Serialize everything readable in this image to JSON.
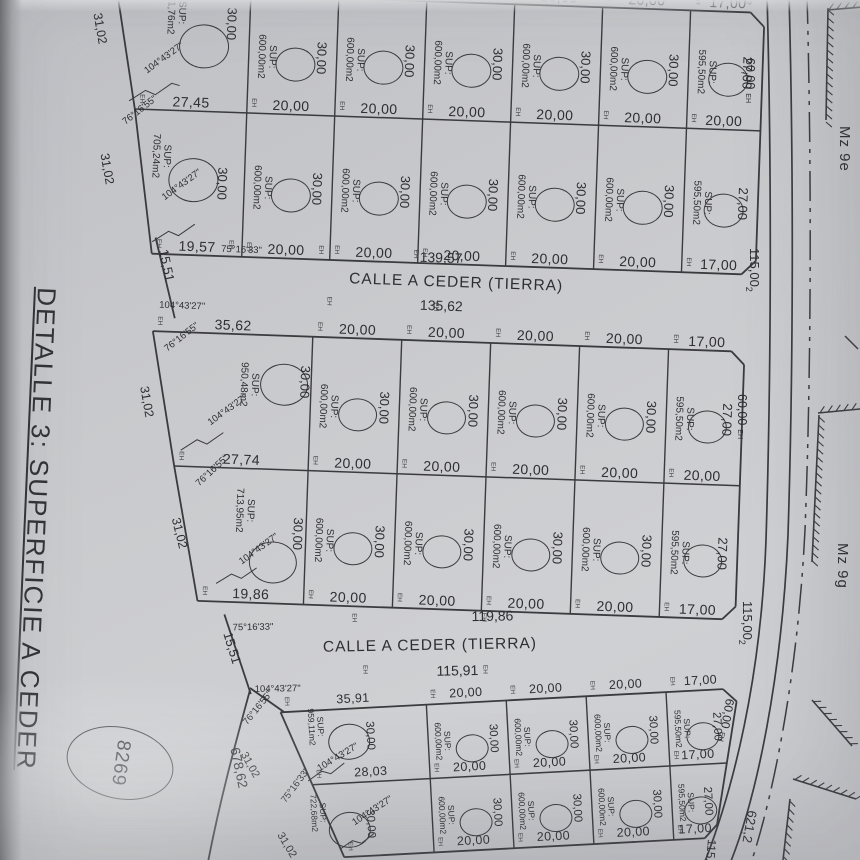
{
  "title": "DETALLE 3: SUPERFICIE A CEDER",
  "markers": {
    "eh": "EH"
  },
  "streets": [
    {
      "angle_nw": "75°16'33\"",
      "total_n": "139,57",
      "name": "CALLE A CEDER (TIERRA)",
      "total_s": "135,62",
      "angle_sw": "104°43'27\"",
      "width_w": "15,51"
    },
    {
      "angle_nw": "75°16'33\"",
      "total_n": "119,86",
      "name": "CALLE A CEDER (TIERRA)",
      "total_s": "115,91",
      "angle_sw": "104°43'27\"",
      "width_w": "15,51"
    }
  ],
  "right_side": {
    "mz_labels": [
      "Mz 9e",
      "Mz 9g"
    ],
    "block_width_label": "115,00",
    "width_sup": "2",
    "top_partial_sup": "2",
    "depth_label": "60,00",
    "road_length_label": "621,2",
    "partial_width_label": "115,0"
  },
  "left_annotations": {
    "parcel_number": "8269",
    "boundary_length": "678,62"
  },
  "blocks": [
    {
      "dims": {
        "top": [
          "",
          "20,00",
          "20,00",
          "20,00",
          "20,00",
          "20,00",
          "17,00"
        ],
        "mid": [
          "27,45",
          "20,00",
          "20,00",
          "20,00",
          "20,00",
          "20,00",
          "20,00"
        ],
        "bot": [
          "19,57",
          "20,00",
          "20,00",
          "20,00",
          "20,00",
          "20,00",
          "17,00"
        ]
      },
      "rows": [
        {
          "lots": [
            {
              "sup": "SUP:",
              "area": "941,76m2",
              "side": "30,00",
              "left_len": "31,02",
              "corner_angle": "75°16'33\"",
              "inner_angle": "104°43'27\""
            },
            {
              "sup": "SUP:",
              "area": "600,00m2",
              "side": "30,00"
            },
            {
              "sup": "SUP:",
              "area": "600,00m2",
              "side": "30,00"
            },
            {
              "sup": "SUP:",
              "area": "600,00m2",
              "side": "30,00"
            },
            {
              "sup": "SUP:",
              "area": "600,00m2",
              "side": "30,00"
            },
            {
              "sup": "SUP:",
              "area": "600,00m2",
              "side": "30,00"
            },
            {
              "sup": "SUP:",
              "area": "595,50m2",
              "side": "27,00"
            }
          ]
        },
        {
          "lots": [
            {
              "sup": "SUP:",
              "area": "705,24m2",
              "side": "30,00",
              "left_len": "31,02",
              "corner_angle": "76°16'55\"",
              "inner_angle": "104°43'27\""
            },
            {
              "sup": "SUP:",
              "area": "600,00m2",
              "side": "30,00"
            },
            {
              "sup": "SUP:",
              "area": "600,00m2",
              "side": "30,00"
            },
            {
              "sup": "SUP:",
              "area": "600,00m2",
              "side": "30,00"
            },
            {
              "sup": "SUP:",
              "area": "600,00m2",
              "side": "30,00"
            },
            {
              "sup": "SUP:",
              "area": "600,00m2",
              "side": "30,00"
            },
            {
              "sup": "SUP:",
              "area": "595,50m2",
              "side": "27,00"
            }
          ]
        }
      ]
    },
    {
      "dims": {
        "top": [
          "35,62",
          "20,00",
          "20,00",
          "20,00",
          "20,00",
          "17,00"
        ],
        "mid": [
          "27,74",
          "20,00",
          "20,00",
          "20,00",
          "20,00",
          "20,00"
        ],
        "bot": [
          "19,86",
          "20,00",
          "20,00",
          "20,00",
          "20,00",
          "17,00"
        ]
      },
      "rows": [
        {
          "lots": [
            {
              "sup": "SUP:",
              "area": "950,48m2",
              "side": "30,00",
              "left_len": "31,02",
              "corner_angle": "76°16'55\"",
              "inner_angle": "104°43'27\""
            },
            {
              "sup": "SUP:",
              "area": "600,00m2",
              "side": "30,00"
            },
            {
              "sup": "SUP:",
              "area": "600,00m2",
              "side": "30,00"
            },
            {
              "sup": "SUP:",
              "area": "600,00m2",
              "side": "30,00"
            },
            {
              "sup": "SUP:",
              "area": "600,00m2",
              "side": "30,00"
            },
            {
              "sup": "SUP:",
              "area": "595,50m2",
              "side": "27,00"
            }
          ]
        },
        {
          "lots": [
            {
              "sup": "SUP:",
              "area": "713,95m2",
              "side": "30,00",
              "left_len": "31,02",
              "corner_angle": "76°16'55\"",
              "inner_angle": "104°43'27\""
            },
            {
              "sup": "SUP:",
              "area": "600,00m2",
              "side": "30,00"
            },
            {
              "sup": "SUP:",
              "area": "600,00m2",
              "side": "30,00"
            },
            {
              "sup": "SUP:",
              "area": "600,00m2",
              "side": "30,00"
            },
            {
              "sup": "SUP:",
              "area": "600,00m2",
              "side": "30,00"
            },
            {
              "sup": "SUP:",
              "area": "595,50m2",
              "side": "27,00"
            }
          ]
        }
      ]
    },
    {
      "dims": {
        "top": [
          "35,91",
          "20,00",
          "20,00",
          "20,00",
          "17,00"
        ],
        "mid": [
          "28,03",
          "20,00",
          "20,00",
          "20,00",
          "17,00"
        ],
        "bot": [
          "",
          "20,00",
          "20,00",
          "20,00",
          "17,00"
        ]
      },
      "rows": [
        {
          "lots": [
            {
              "sup": "SUP:",
              "area": "959,11m2",
              "side": "30,00",
              "left_len": "31,02",
              "corner_angle": "76°16'55\"",
              "inner_angle": "104°43'27\""
            },
            {
              "sup": "SUP:",
              "area": "600,00m2",
              "side": "30,00"
            },
            {
              "sup": "SUP:",
              "area": "600,00m2",
              "side": "30,00"
            },
            {
              "sup": "SUP:",
              "area": "600,00m2",
              "side": "30,00"
            },
            {
              "sup": "SUP:",
              "area": "595,50m2",
              "side": "27,00"
            }
          ]
        },
        {
          "lots": [
            {
              "sup": "SUP:",
              "area": "722,68m2",
              "side": "30,00",
              "left_len": "31,02",
              "corner_angle": "75°16'33\"",
              "inner_angle": "104°43'27\""
            },
            {
              "sup": "SUP:",
              "area": "600,00m2",
              "side": "30,00"
            },
            {
              "sup": "SUP:",
              "area": "600,00m2",
              "side": "30,00"
            },
            {
              "sup": "SUP:",
              "area": "600,00m2",
              "side": "30,00"
            },
            {
              "sup": "SUP:",
              "area": "595,50m2",
              "side": "27,00"
            }
          ]
        }
      ]
    }
  ]
}
